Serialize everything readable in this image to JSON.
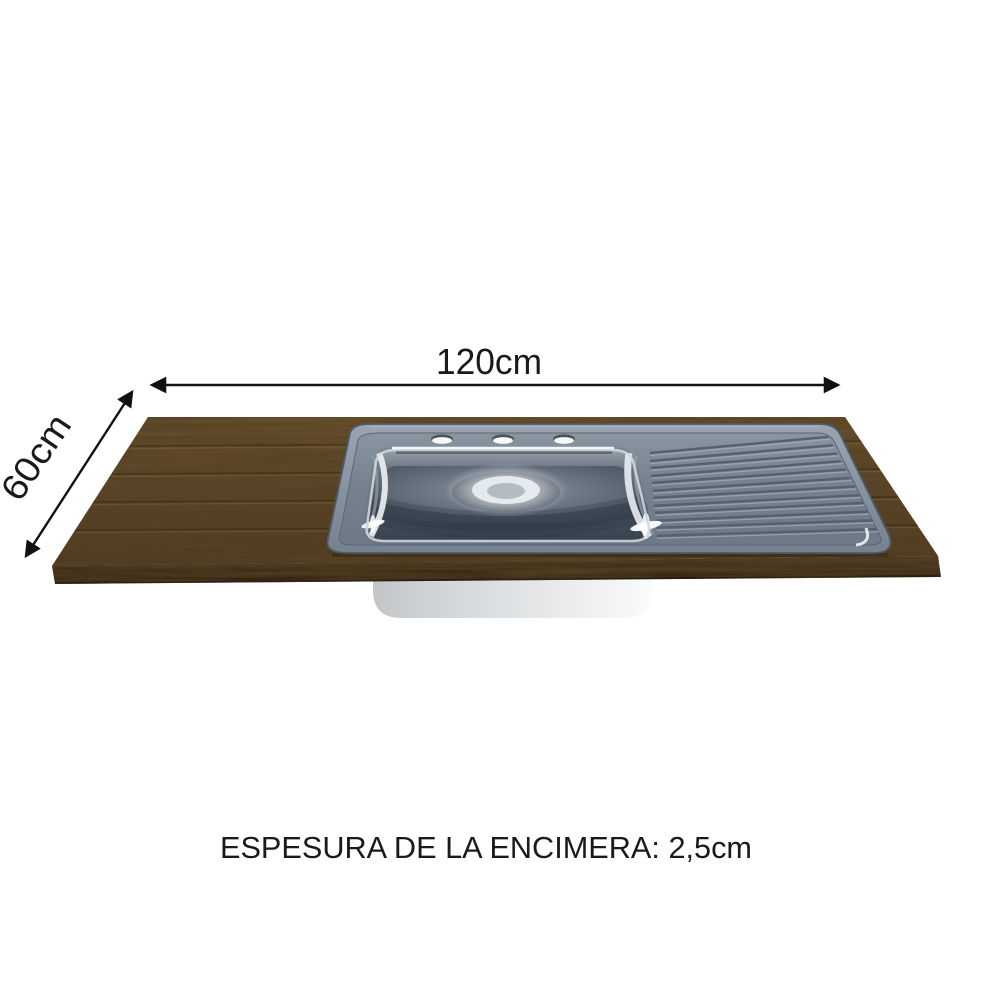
{
  "dimensions": {
    "width_label": "120cm",
    "depth_label": "60cm"
  },
  "caption": "ESPESURA DE LA ENCIMERA: 2,5cm",
  "colors": {
    "background": "#ffffff",
    "text": "#1a1a1a",
    "wood_top": "#5d4429",
    "wood_edge": "#3a2a18",
    "sink_steel": "#8693a2",
    "sink_panel": "#76828f",
    "basin_deep": "#39434f",
    "under_basin": "#d7dadd"
  },
  "icons": {
    "width_arrow": "double-headed-horizontal-arrow",
    "depth_arrow": "double-headed-diagonal-arrow"
  }
}
